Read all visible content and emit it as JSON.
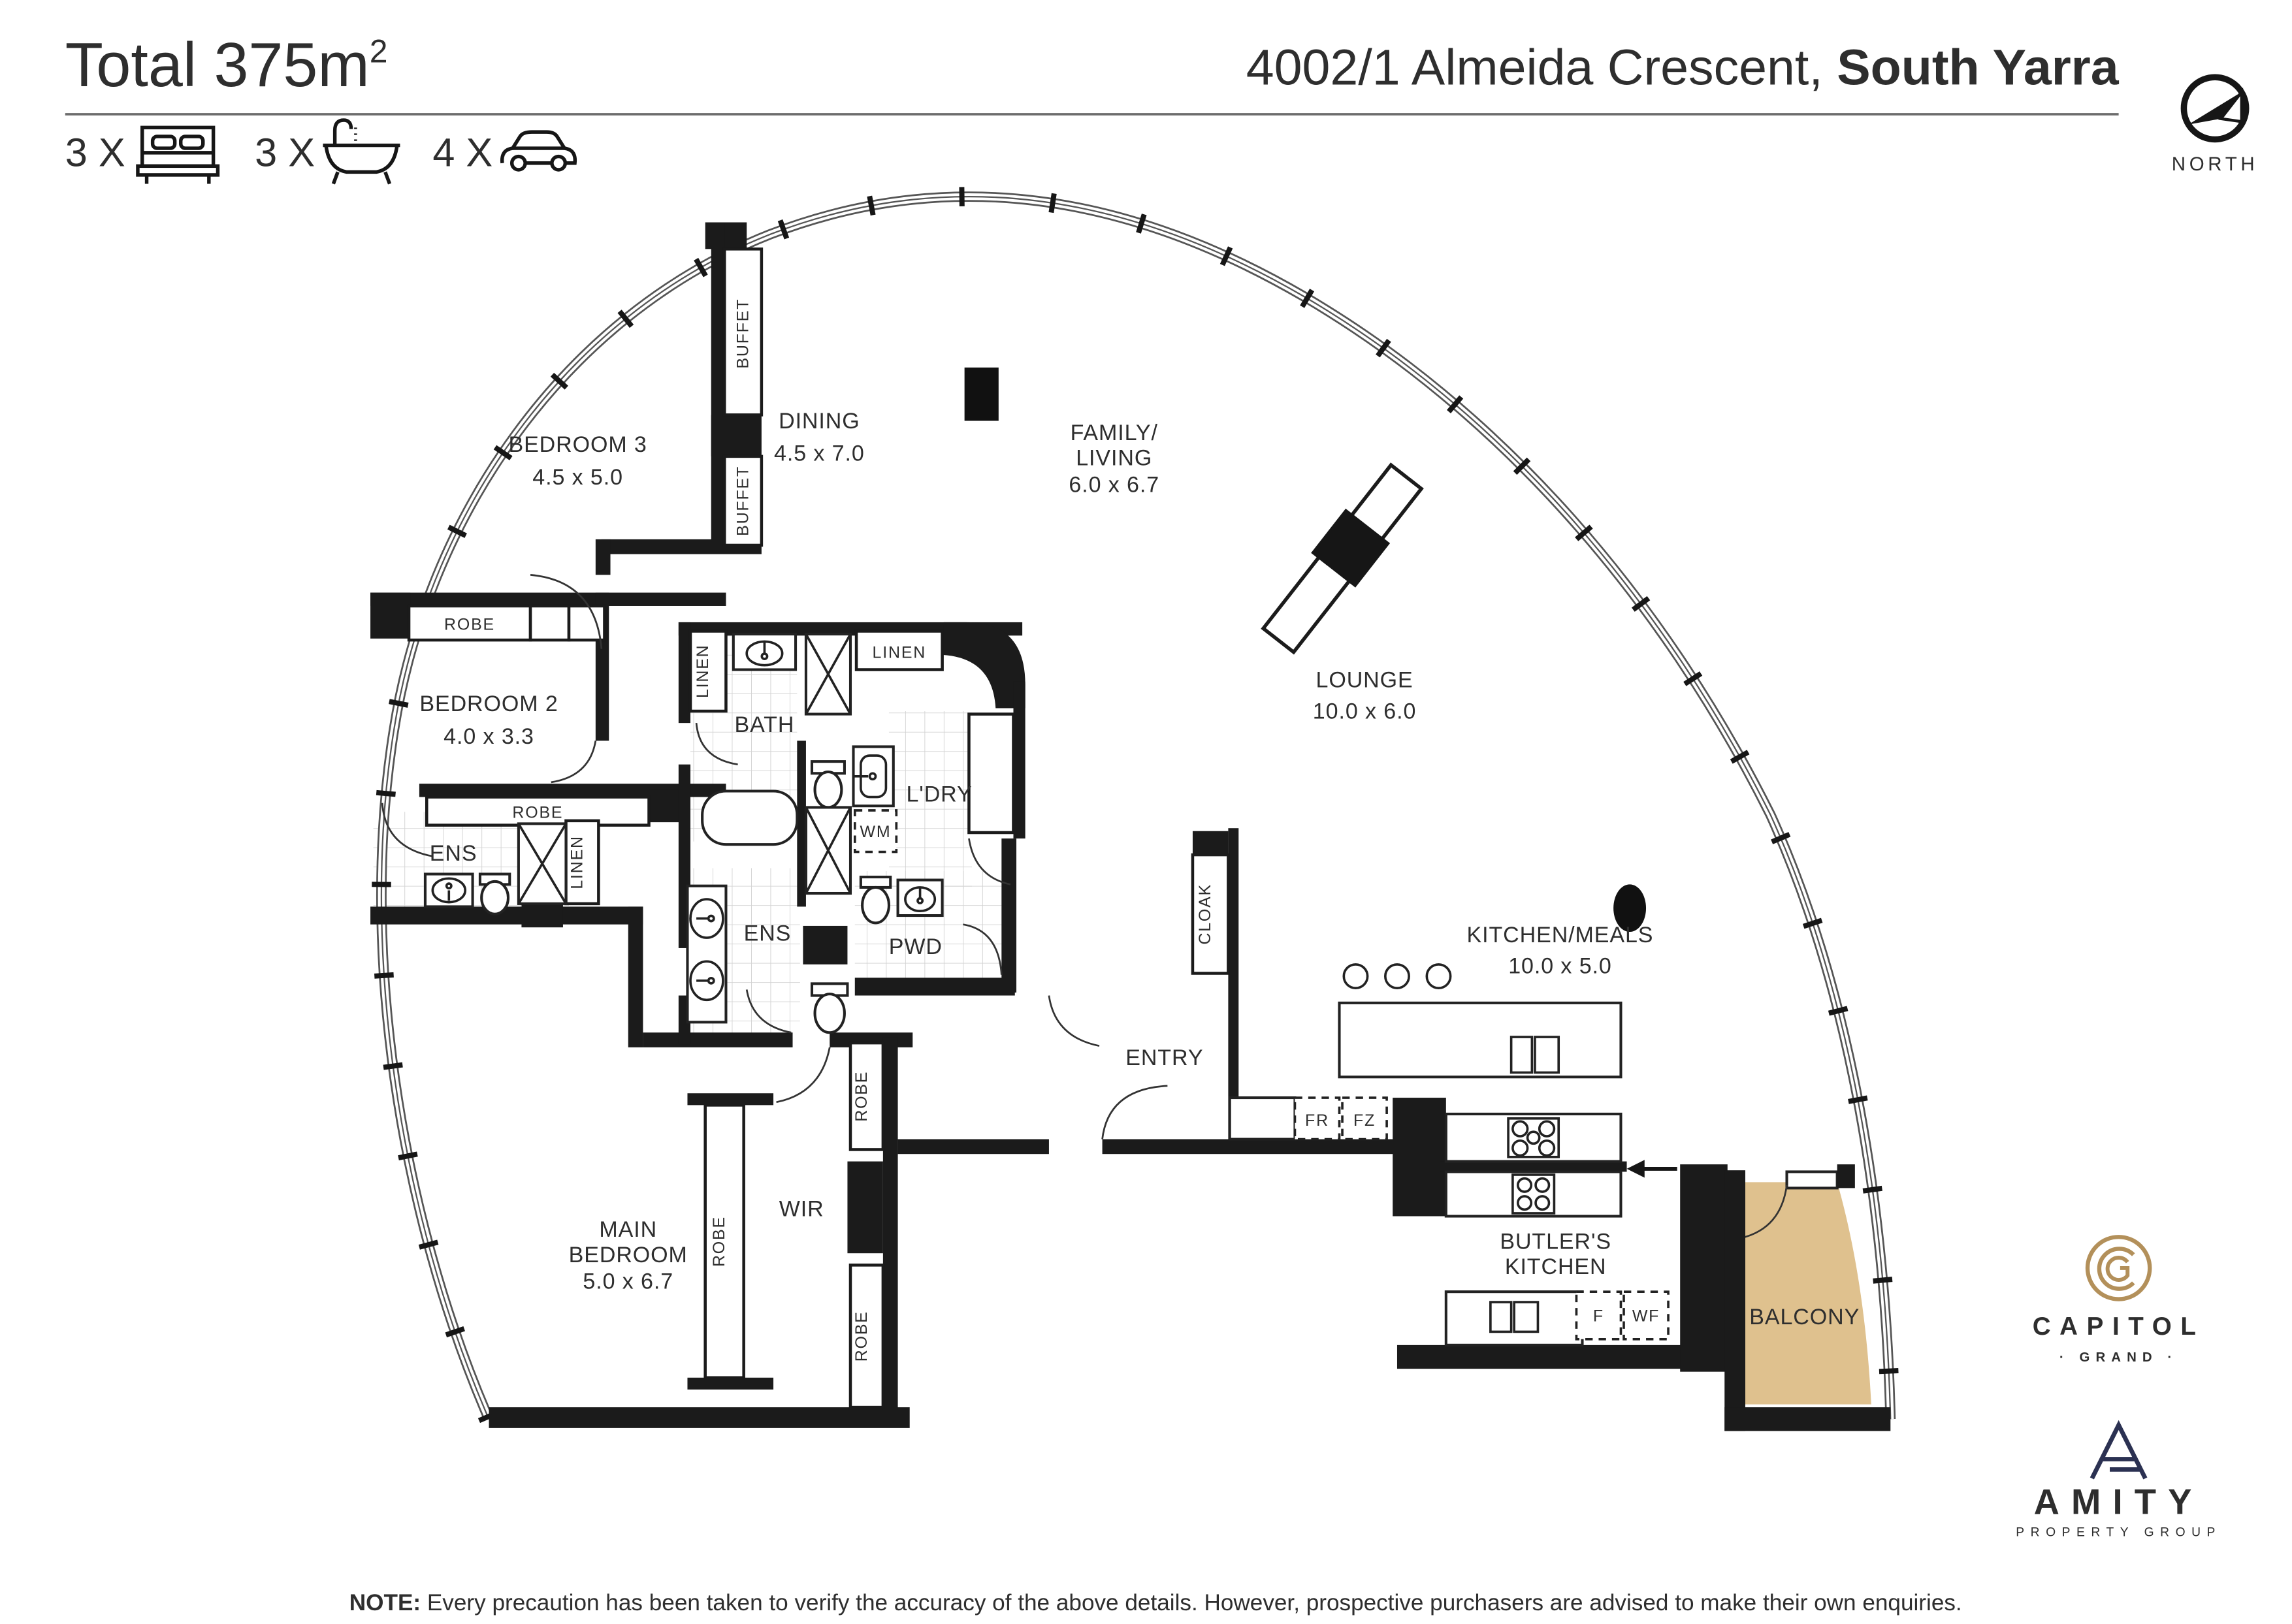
{
  "header": {
    "title": "Total 375m",
    "title_sup": "2",
    "address_main": "4002/1 Almeida Crescent, ",
    "address_suburb": "South Yarra",
    "beds": "3 X",
    "baths": "3 X",
    "cars": "4 X"
  },
  "compass": {
    "label": "NORTH"
  },
  "rooms": {
    "bedroom3": {
      "name": "BEDROOM 3",
      "dims": "4.5 x 5.0"
    },
    "dining": {
      "name": "DINING",
      "dims": "4.5 x 7.0"
    },
    "family": {
      "line1": "FAMILY/",
      "line2": "LIVING",
      "dims": "6.0 x 6.7"
    },
    "lounge": {
      "name": "LOUNGE",
      "dims": "10.0 x 6.0"
    },
    "bedroom2": {
      "name": "BEDROOM 2",
      "dims": "4.0 x 3.3"
    },
    "bath": {
      "name": "BATH"
    },
    "ldry": {
      "name": "L'DRY"
    },
    "ens": {
      "name": "ENS"
    },
    "pwd": {
      "name": "PWD"
    },
    "kitchen": {
      "name": "KITCHEN/MEALS",
      "dims": "10.0 x 5.0"
    },
    "entry": {
      "name": "ENTRY"
    },
    "cloak": {
      "name": "CLOAK"
    },
    "wir": {
      "name": "WIR"
    },
    "main_bedroom": {
      "line1": "MAIN",
      "line2": "BEDROOM",
      "dims": "5.0 x 6.7"
    },
    "butlers_kitchen": {
      "line1": "BUTLER'S",
      "line2": "KITCHEN"
    },
    "balcony": {
      "name": "BALCONY"
    }
  },
  "joinery": {
    "buffet": "BUFFET",
    "robe": "ROBE",
    "linen": "LINEN"
  },
  "appliances": {
    "wm": "WM",
    "fr": "FR",
    "fz": "FZ",
    "f": "F",
    "wf": "WF"
  },
  "note": {
    "label": "NOTE:",
    "text": " Every precaution has been taken to verify the accuracy of the above details. However, prospective purchasers are advised to make their own enquiries."
  },
  "logos": {
    "capitol": "CAPITOL",
    "capitol_sub": "· GRAND ·",
    "amity": "AMITY",
    "amity_sub": "PROPERTY GROUP"
  },
  "colors": {
    "wall": "#1b1b1b",
    "balcony_fill": "#dfc18e",
    "capitol_gold": "#b3905a",
    "amity_navy": "#2b3152"
  }
}
